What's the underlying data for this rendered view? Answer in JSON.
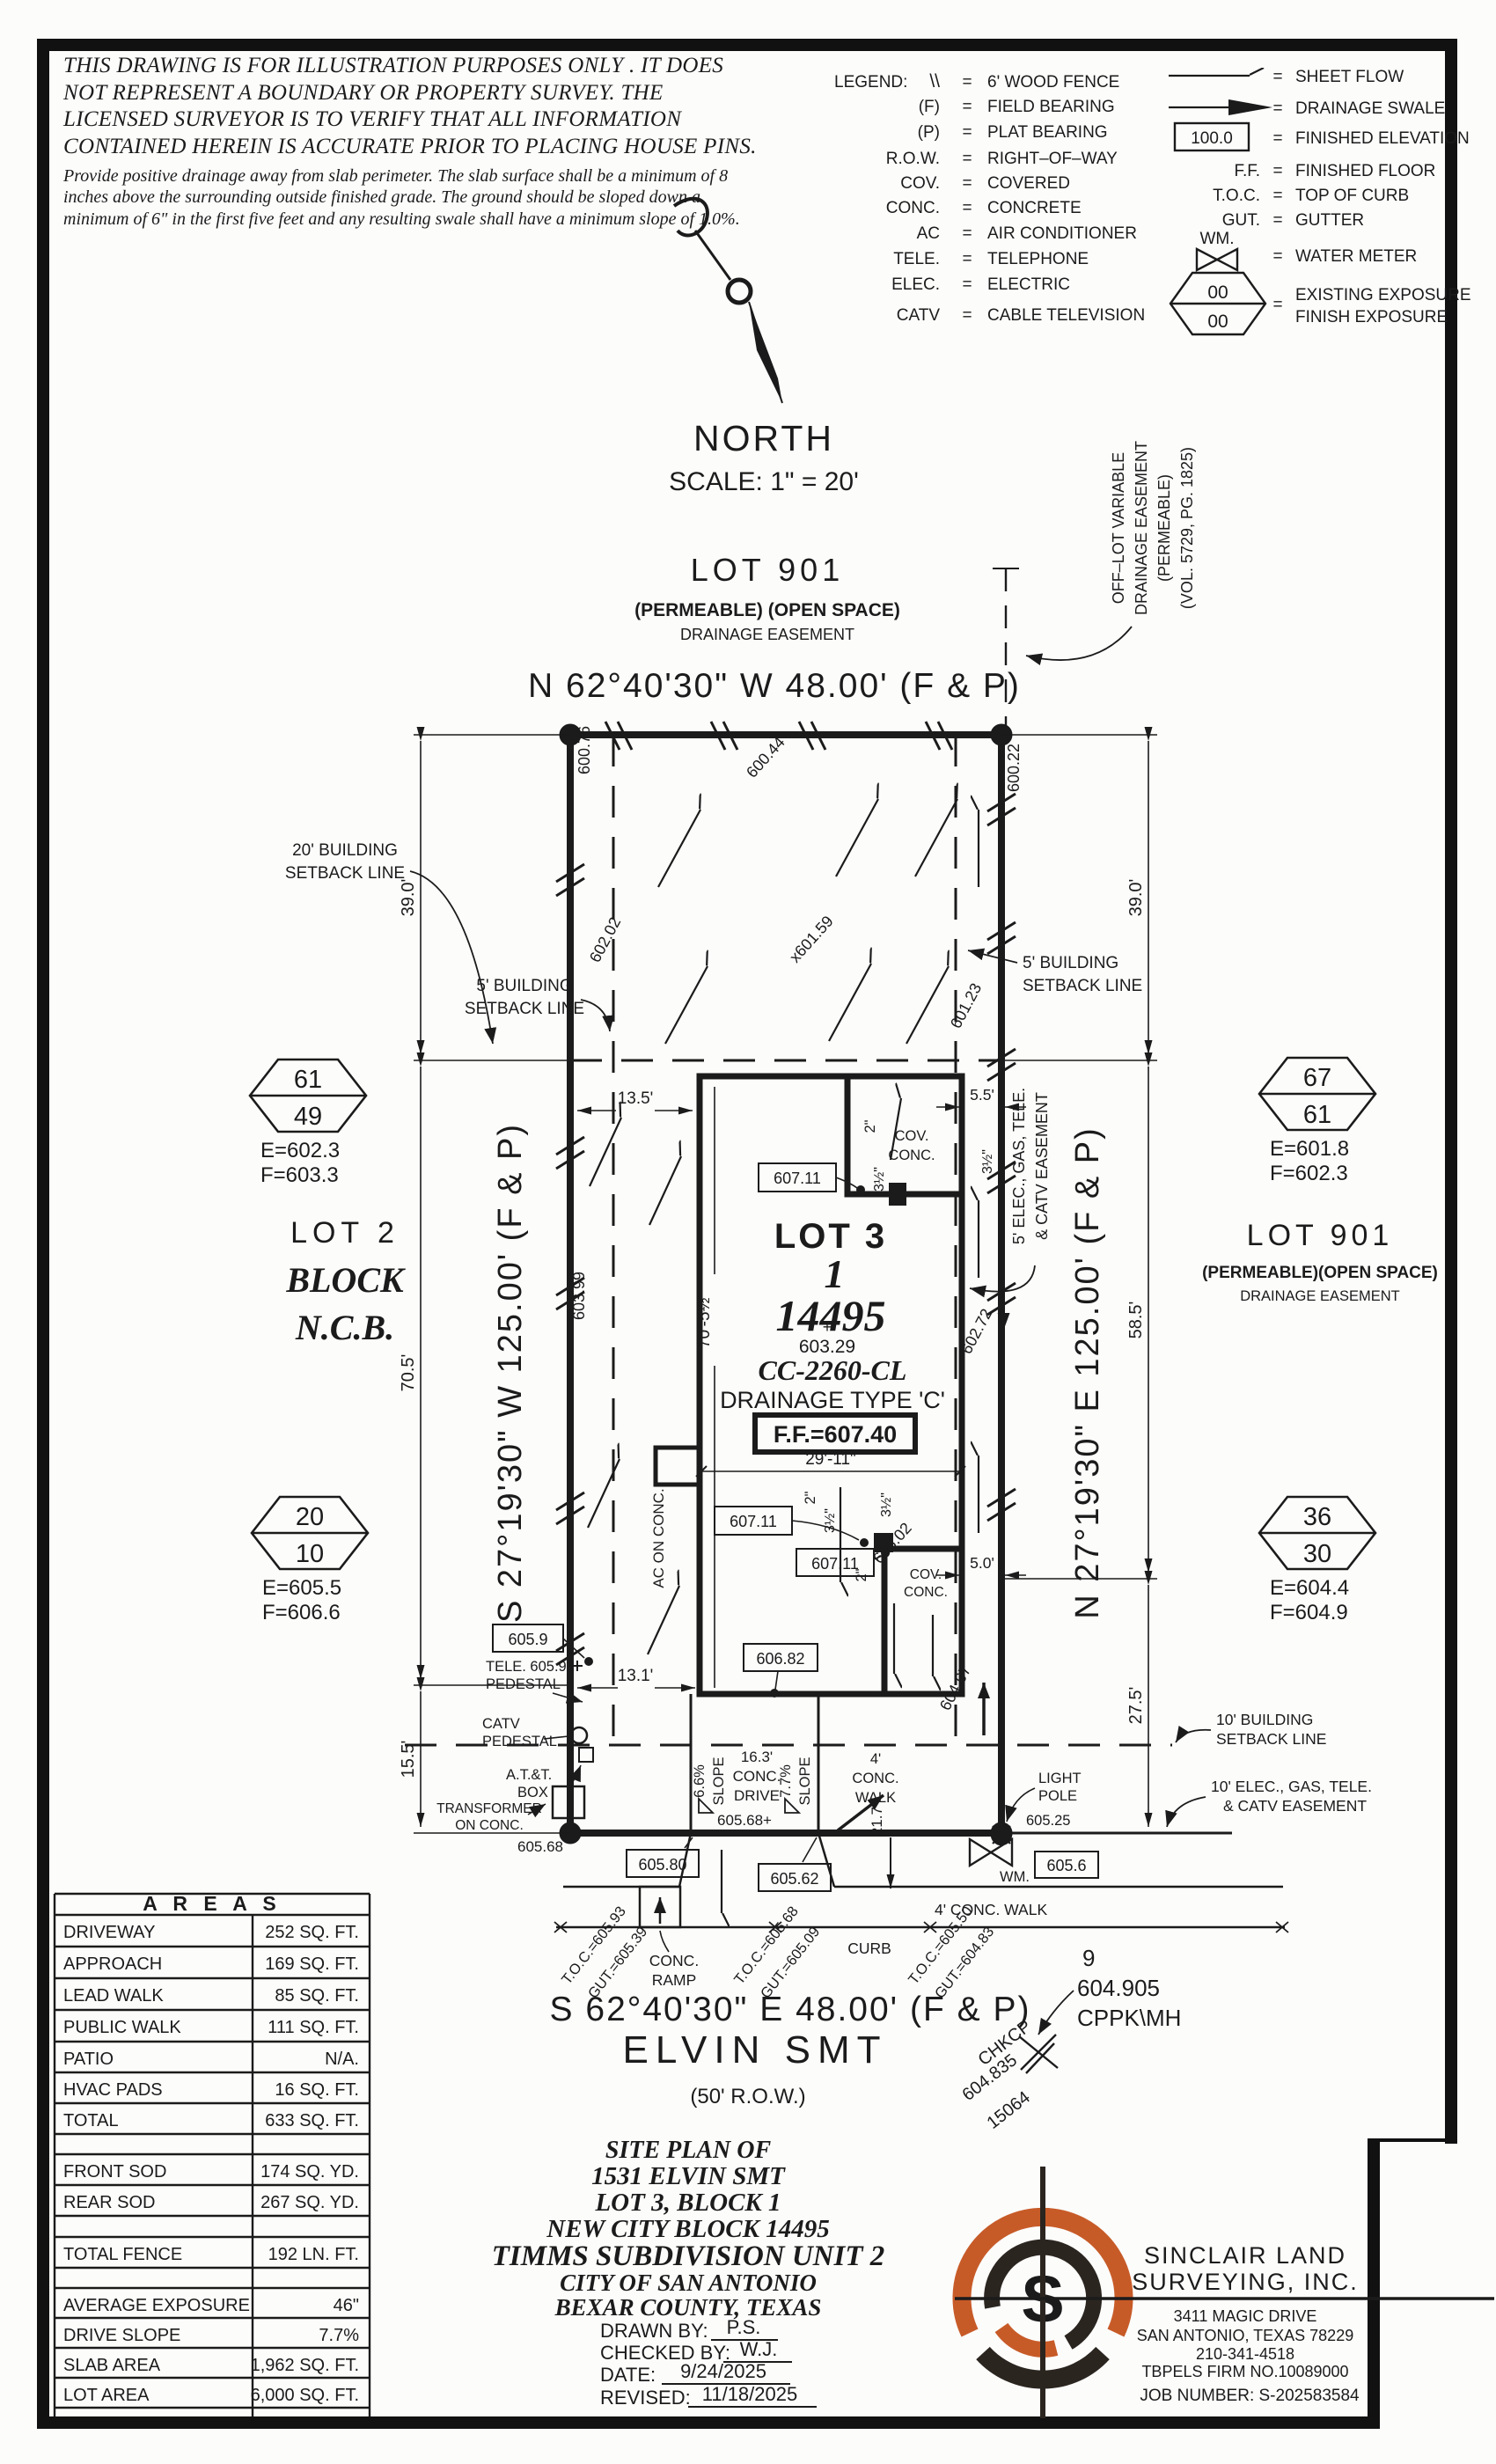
{
  "disc": {
    "p1": "THIS DRAWING IS FOR ILLUSTRATION PURPOSES ONLY . IT DOES NOT REPRESENT A BOUNDARY OR PROPERTY SURVEY. THE LICENSED SURVEYOR IS TO VERIFY THAT ALL INFORMATION CONTAINED HEREIN IS ACCURATE PRIOR TO PLACING HOUSE PINS.",
    "p2": "Provide positive drainage away from slab perimeter. The slab surface shall be a minimum of 8 inches above the surrounding outside finished grade. The ground should be sloped down a minimum of 6\" in the first five feet and any resulting swale shall have a minimum slope of 1.0%."
  },
  "legend": {
    "title": "LEGEND:",
    "eq": "=",
    "fence_sym": "\\\\",
    "fe_value": "100.0",
    "hex_top": "00",
    "hex_bot": "00",
    "left": [
      {
        "t": "",
        "d": "6' WOOD FENCE"
      },
      {
        "t": "(F)",
        "d": "FIELD BEARING"
      },
      {
        "t": "(P)",
        "d": "PLAT BEARING"
      },
      {
        "t": "R.O.W.",
        "d": "RIGHT–OF–WAY"
      },
      {
        "t": "COV.",
        "d": "COVERED"
      },
      {
        "t": "CONC.",
        "d": "CONCRETE"
      },
      {
        "t": "AC",
        "d": "AIR CONDITIONER"
      },
      {
        "t": "TELE.",
        "d": "TELEPHONE"
      },
      {
        "t": "ELEC.",
        "d": "ELECTRIC"
      },
      {
        "t": "CATV",
        "d": "CABLE TELEVISION"
      }
    ],
    "right": {
      "sheet_flow": "SHEET FLOW",
      "swale": "DRAINAGE SWALE",
      "fin_elev": "FINISHED ELEVATION",
      "ff_t": "F.F.",
      "ff_d": "FINISHED FLOOR",
      "toc_t": "T.O.C.",
      "toc_d": "TOP OF CURB",
      "gut_t": "GUT.",
      "gut_d": "GUTTER",
      "wm_t": "WM.",
      "wm_d": "WATER METER",
      "exp1": "EXISTING EXPOSURE",
      "exp2": "FINISH EXPOSURE"
    }
  },
  "north": {
    "n": "NORTH",
    "scale": "SCALE:  1\" = 20'"
  },
  "plan": {
    "lot901top": {
      "t": "LOT 901",
      "s1": "(PERMEABLE) (OPEN SPACE)",
      "s2": "DRAINAGE EASEMENT"
    },
    "offlot": {
      "l1": "OFF–LOT VARIABLE",
      "l2": "DRAINAGE EASEMENT",
      "l3": "(PERMEABLE)",
      "l4": "(VOL. 5729, PG. 1825)"
    },
    "brgN": "N 62°40'30\" W 48.00' (F & P)",
    "brgS": "S 62°40'30\" E 48.00' (F & P)",
    "brgW": "S 27°19'30\" W 125.00' (F & P)",
    "brgE": "N 27°19'30\" E 125.00' (F & P)",
    "street": "ELVIN SMT",
    "row": "(50' R.O.W.)",
    "sb20a": "20' BUILDING",
    "sb20b": "SETBACK LINE",
    "sb5a": "5' BUILDING",
    "sb5b": "SETBACK LINE",
    "sb10a": "10' BUILDING",
    "sb10b": "SETBACK LINE",
    "e10a": "10' ELEC., GAS, TELE.",
    "e10b": "& CATV EASEMENT",
    "e5a": "5' ELEC., GAS, TELE.",
    "e5b": "& CATV EASEMENT",
    "d39": "39.0'",
    "d705": "70.5'",
    "d155": "15.5'",
    "d585": "58.5'",
    "d275": "27.5'",
    "d135": "13.5'",
    "d131": "13.1'",
    "d55": "5.5'",
    "d50": "5.0'",
    "d2911": "29'-11\"",
    "dh705": "70'-5½\"",
    "d217": "21.7'",
    "d2in": "2\"",
    "d35": "3½\"",
    "house": {
      "lot": "LOT 3",
      "blk": "1",
      "ncb": "14495",
      "plus": "+",
      "spot": "603.29",
      "cc": "CC-2260-CL",
      "dt": "DRAINAGE TYPE 'C'",
      "ff": "F.F.=607.40"
    },
    "cov1": "COV.",
    "cov2": "CONC.",
    "ac": "AC ON CONC.",
    "ev": {
      "a": "600.76",
      "b": "602.02",
      "c": "603.99",
      "d": "600.44",
      "e": "x601.59",
      "f": "600.22",
      "g": "601.23",
      "h": "602.72",
      "i": "604.67",
      "j": "607.11",
      "k": "606.82",
      "l": "605.9",
      "m": "TELE. 605.91",
      "n": "605.02",
      "o": "605.68",
      "p": "605.68+",
      "q": "605.80",
      "r": "605.62",
      "s": "605.25",
      "t": "605.6"
    },
    "ped": "PEDESTAL",
    "catv": "CATV",
    "att1": "A.T.&T.",
    "att2": "BOX",
    "tr1": "TRANSFORMER",
    "tr2": "ON CONC.",
    "lp1": "LIGHT",
    "lp2": "POLE",
    "wm": "WM.",
    "ramp1": "CONC.",
    "ramp2": "RAMP",
    "walk": "4' CONC. WALK",
    "walkS1": "4'",
    "walkS2": "CONC.",
    "walkS3": "WALK",
    "drv1": "16.3'",
    "drv2": "CONC.",
    "drv3": "DRIVE",
    "sl1": "6.6%",
    "sl2": "7.7%",
    "slS": "SLOPE",
    "curb": "CURB",
    "toc": [
      {
        "t": "T.O.C.=605.93",
        "g": "GUT.=605.39"
      },
      {
        "t": "T.O.C.=605.68",
        "g": "GUT.=605.09"
      },
      {
        "t": "T.O.C.=605.50",
        "g": "GUT.=604.83"
      }
    ],
    "mh": {
      "n": "9",
      "v": "604.905",
      "id": "CPPK\\MH"
    },
    "chk": {
      "a": "CHKCP",
      "b": "604.835",
      "c": "15064"
    },
    "hex": [
      {
        "a": "61",
        "b": "49",
        "e": "E=602.3",
        "f": "F=603.3"
      },
      {
        "a": "67",
        "b": "61",
        "e": "E=601.8",
        "f": "F=602.3"
      },
      {
        "a": "20",
        "b": "10",
        "e": "E=605.5",
        "f": "F=606.6"
      },
      {
        "a": "36",
        "b": "30",
        "e": "E=604.4",
        "f": "F=604.9"
      }
    ],
    "lot2": {
      "a": "LOT 2",
      "b": "BLOCK",
      "c": "N.C.B."
    },
    "lot901r": {
      "t": "LOT 901",
      "s1": "(PERMEABLE)(OPEN SPACE)",
      "s2": "DRAINAGE EASEMENT"
    }
  },
  "areas": {
    "title": "A R E A S",
    "rows": [
      {
        "l": "DRIVEWAY",
        "v": "252 SQ. FT."
      },
      {
        "l": "APPROACH",
        "v": "169 SQ. FT."
      },
      {
        "l": "LEAD WALK",
        "v": "85 SQ. FT."
      },
      {
        "l": "PUBLIC WALK",
        "v": "111 SQ. FT."
      },
      {
        "l": "PATIO",
        "v": "N/A."
      },
      {
        "l": "HVAC PADS",
        "v": "16 SQ. FT."
      },
      {
        "l": "TOTAL",
        "v": "633 SQ. FT."
      },
      {
        "l": "FRONT SOD",
        "v": "174 SQ. YD."
      },
      {
        "l": "REAR SOD",
        "v": "267 SQ. YD."
      },
      {
        "l": "TOTAL FENCE",
        "v": "192 LN. FT."
      },
      {
        "l": "AVERAGE EXPOSURE",
        "v": "46\""
      },
      {
        "l": "DRIVE SLOPE",
        "v": "7.7%"
      },
      {
        "l": "SLAB AREA",
        "v": "1,962 SQ. FT."
      },
      {
        "l": "LOT AREA",
        "v": "6,000 SQ. FT."
      }
    ]
  },
  "title": {
    "l1": "SITE PLAN OF",
    "l2": "1531 ELVIN SMT",
    "l3": "LOT 3, BLOCK 1",
    "l4": "NEW CITY BLOCK 14495",
    "l5": "TIMMS SUBDIVISION UNIT 2",
    "l6": "CITY OF SAN ANTONIO",
    "l7": "BEXAR COUNTY, TEXAS",
    "drawn_l": "DRAWN BY:",
    "drawn_v": "P.S.",
    "checked_l": "CHECKED BY:",
    "checked_v": "W.J.",
    "date_l": "DATE:",
    "date_v": "9/24/2025",
    "rev_l": "REVISED:",
    "rev_v": "11/18/2025"
  },
  "company": {
    "logo_s": "S",
    "n1": "SINCLAIR LAND",
    "n2": "SURVEYING, INC.",
    "a1": "3411 MAGIC DRIVE",
    "a2": "SAN ANTONIO, TEXAS 78229",
    "ph": "210-341-4518",
    "firm": "TBPELS FIRM NO.10089000",
    "job": "JOB NUMBER: S-202583584"
  },
  "colors": {
    "ink": "#1b1b1b",
    "accent": "#C75B28"
  }
}
